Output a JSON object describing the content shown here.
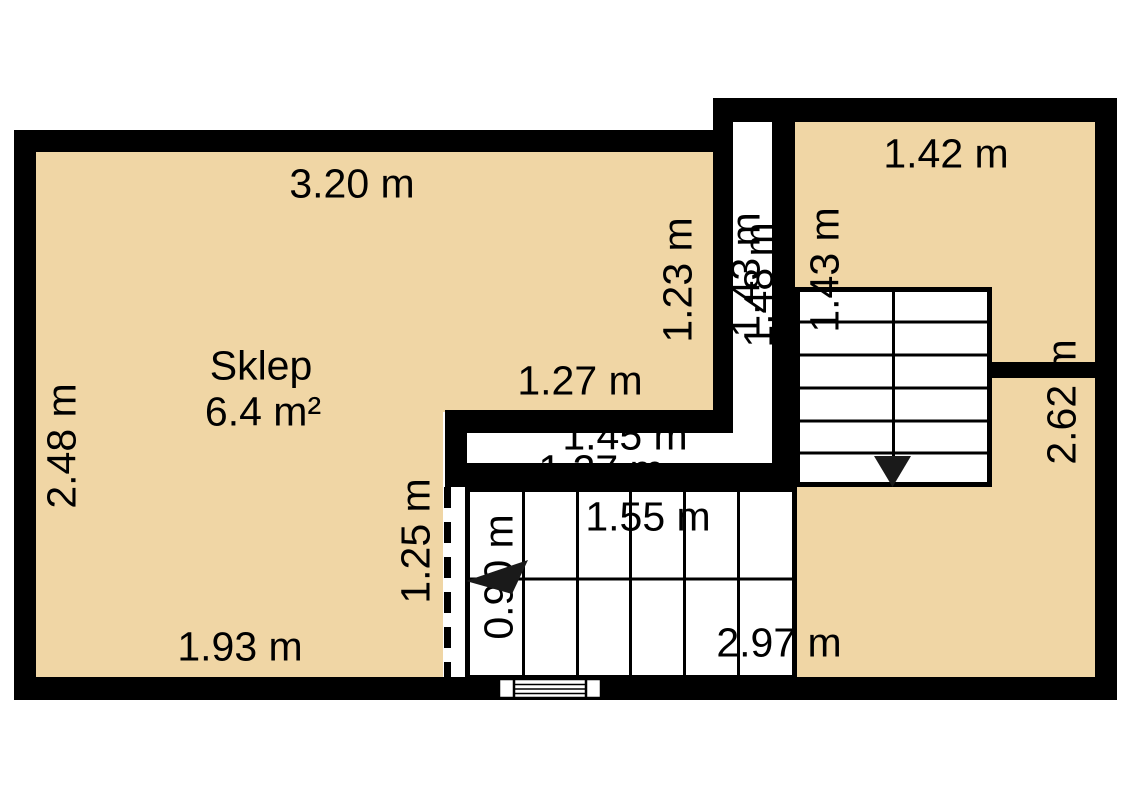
{
  "room": {
    "name": "Sklep",
    "area": "6.4 m²"
  },
  "dims": {
    "top_width": "3.20 m",
    "left_height": "2.48 m",
    "sklep_inner_width": "1.27 m",
    "sklep_right_height": "1.23 m",
    "corridor_inner": "1.43 m",
    "corridor_outer": "1.48 m",
    "right_room_height": "1.43 m",
    "right_room_width": "1.42 m",
    "right_total_height": "2.62 m",
    "hall_upper": "1.45 m",
    "hall_lower": "1.27 m",
    "stair_run_length": "1.55 m",
    "stair_run_width": "0.90 m",
    "sklep_lower_height": "1.25 m",
    "bottom_left_width": "1.93 m",
    "bottom_right_width": "2.97 m"
  },
  "icons": {
    "stair_down_arrow": "stair-direction-down-arrow",
    "stair_left_arrow": "stair-direction-left-arrow",
    "window": "window-symbol",
    "opening_dashed_line": "room-opening-dashed-line"
  },
  "colors": {
    "room_fill": "#f0d6a5",
    "wall": "#000000",
    "background": "#ffffff",
    "text": "#000000"
  }
}
